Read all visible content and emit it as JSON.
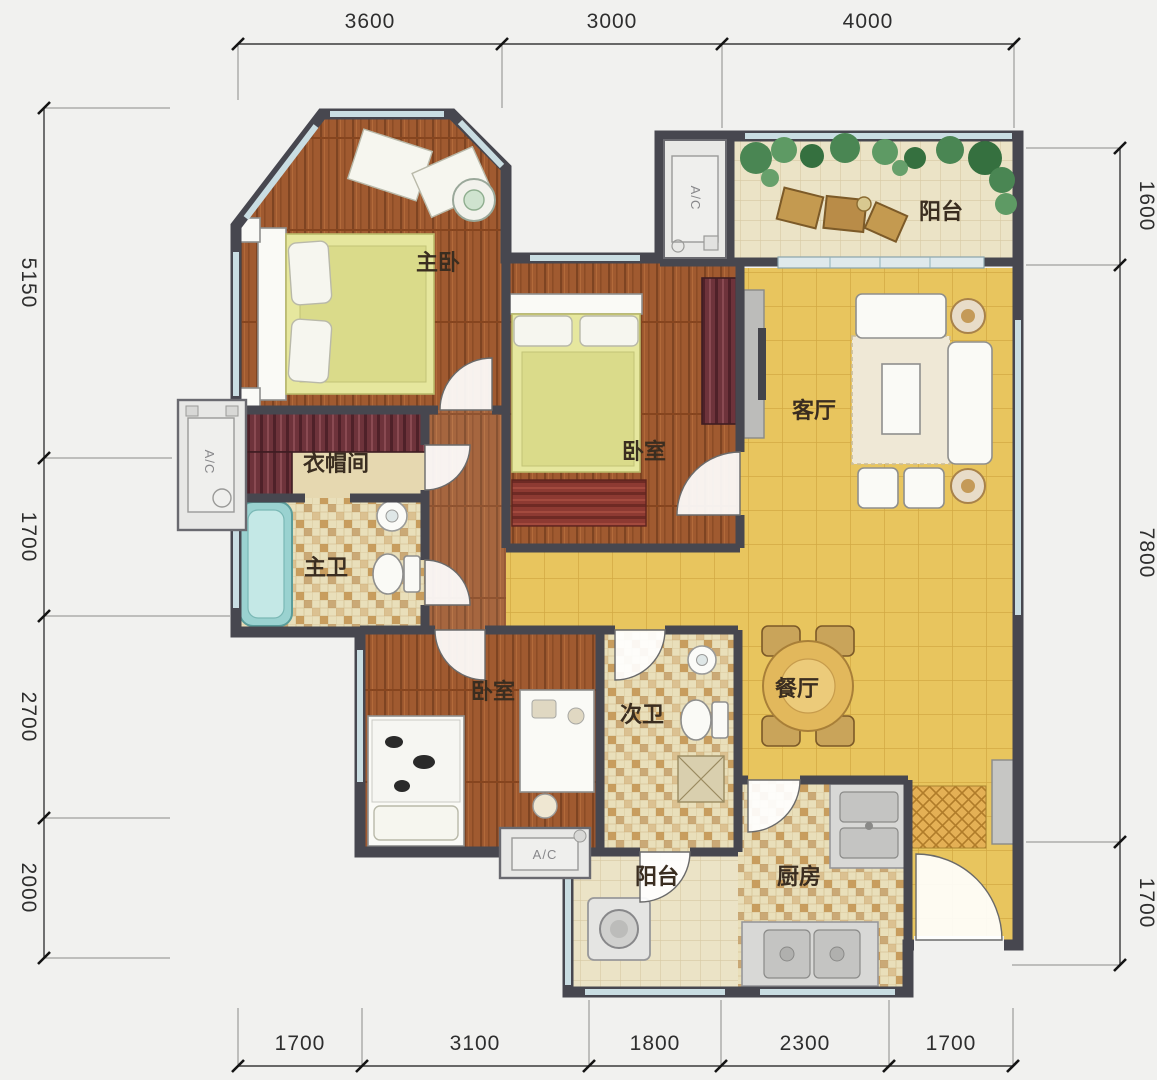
{
  "plan_title": "floor-plan",
  "rooms": [
    {
      "name": "master-bedroom",
      "label": "主卧"
    },
    {
      "name": "balcony-north",
      "label": "阳台"
    },
    {
      "name": "bedroom-middle",
      "label": "卧室"
    },
    {
      "name": "living-room",
      "label": "客厅"
    },
    {
      "name": "cloakroom",
      "label": "衣帽间"
    },
    {
      "name": "master-bathroom",
      "label": "主卫"
    },
    {
      "name": "bedroom-south",
      "label": "卧室"
    },
    {
      "name": "second-bathroom",
      "label": "次卫"
    },
    {
      "name": "dining-room",
      "label": "餐厅"
    },
    {
      "name": "balcony-south",
      "label": "阳台"
    },
    {
      "name": "kitchen",
      "label": "厨房"
    }
  ],
  "ac_units": [
    {
      "name": "ac-platform-north",
      "label": "A/C"
    },
    {
      "name": "ac-platform-west",
      "label": "A/C"
    },
    {
      "name": "ac-platform-south",
      "label": "A/C"
    }
  ],
  "dimensions": {
    "top": [
      "3600",
      "3000",
      "4000"
    ],
    "left": [
      "5150",
      "1700",
      "2700",
      "2000"
    ],
    "right": [
      "1600",
      "7800",
      "1700"
    ],
    "bottom": [
      "1700",
      "3100",
      "1800",
      "2300",
      "1700"
    ]
  },
  "colors": {
    "background": "#f1f1ef",
    "wall": "#47474f",
    "wood_floor": "#a05a30",
    "tile_yellow": "#e8c55e",
    "tile_beige": "#ebe3c6",
    "bathtub": "#9ad2d0",
    "window": "#c9dde2",
    "plant": "#4a8653",
    "rug_red": "#8d3a32",
    "wardrobe_maroon": "#6e333b",
    "dimension_text": "#2e2e2e"
  }
}
